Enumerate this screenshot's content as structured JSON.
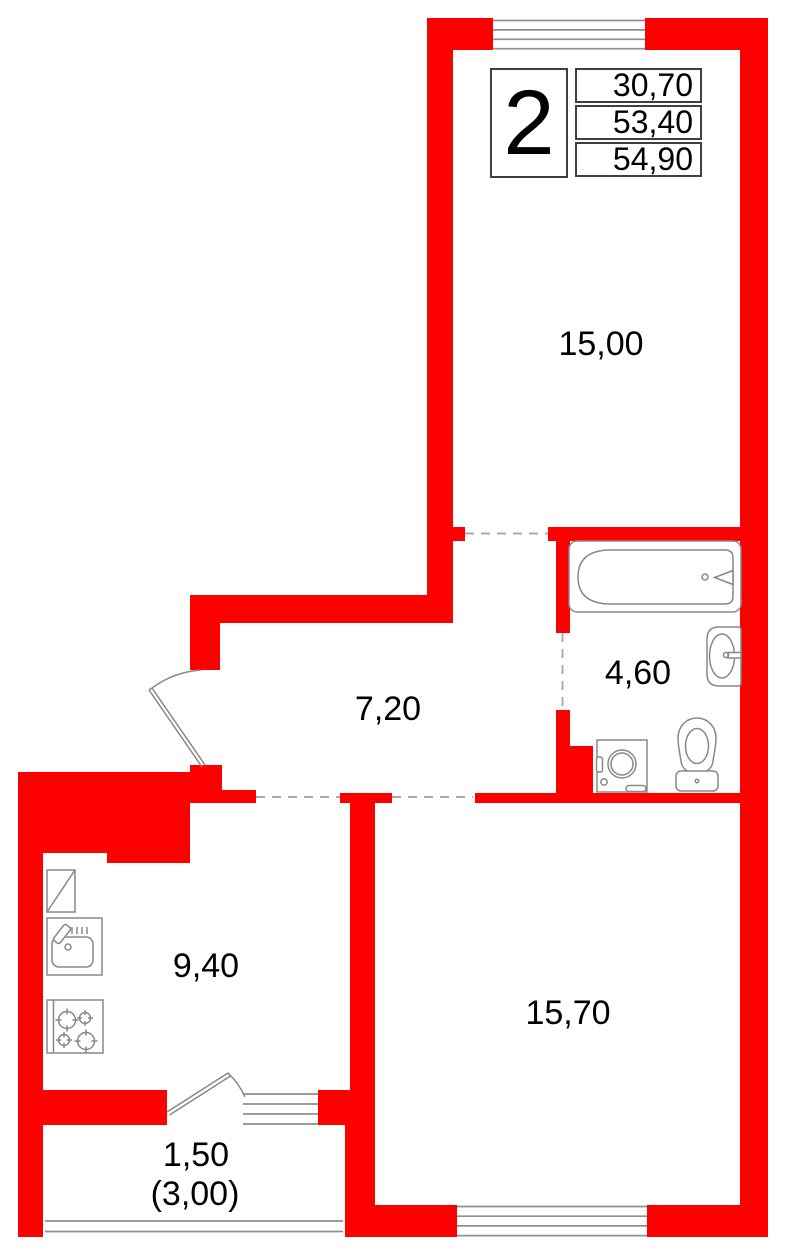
{
  "info_box": {
    "flat_number": "2",
    "values": [
      "30,70",
      "53,40",
      "54,90"
    ]
  },
  "rooms": {
    "living_room": {
      "area": "15,00"
    },
    "hallway": {
      "area": "7,20"
    },
    "bathroom": {
      "area": "4,60"
    },
    "kitchen": {
      "area": "9,40"
    },
    "bedroom": {
      "area": "15,70"
    },
    "balcony": {
      "area_reduced": "1,50",
      "area_total": "(3,00)"
    }
  },
  "fixtures": [
    "bathtub",
    "wash-basin",
    "toilet",
    "washing-machine",
    "kitchen-counter",
    "kitchen-sink",
    "stove",
    "hall-door",
    "balcony-door",
    "top-window",
    "balcony-window",
    "bedroom-window",
    "balcony-railing"
  ],
  "colors": {
    "wall": "#fe0000",
    "fixture": "#888888",
    "dash": "#ababab",
    "window_line": "#8f8f8f",
    "text": "#000000",
    "box_border": "#3f3f3f"
  }
}
